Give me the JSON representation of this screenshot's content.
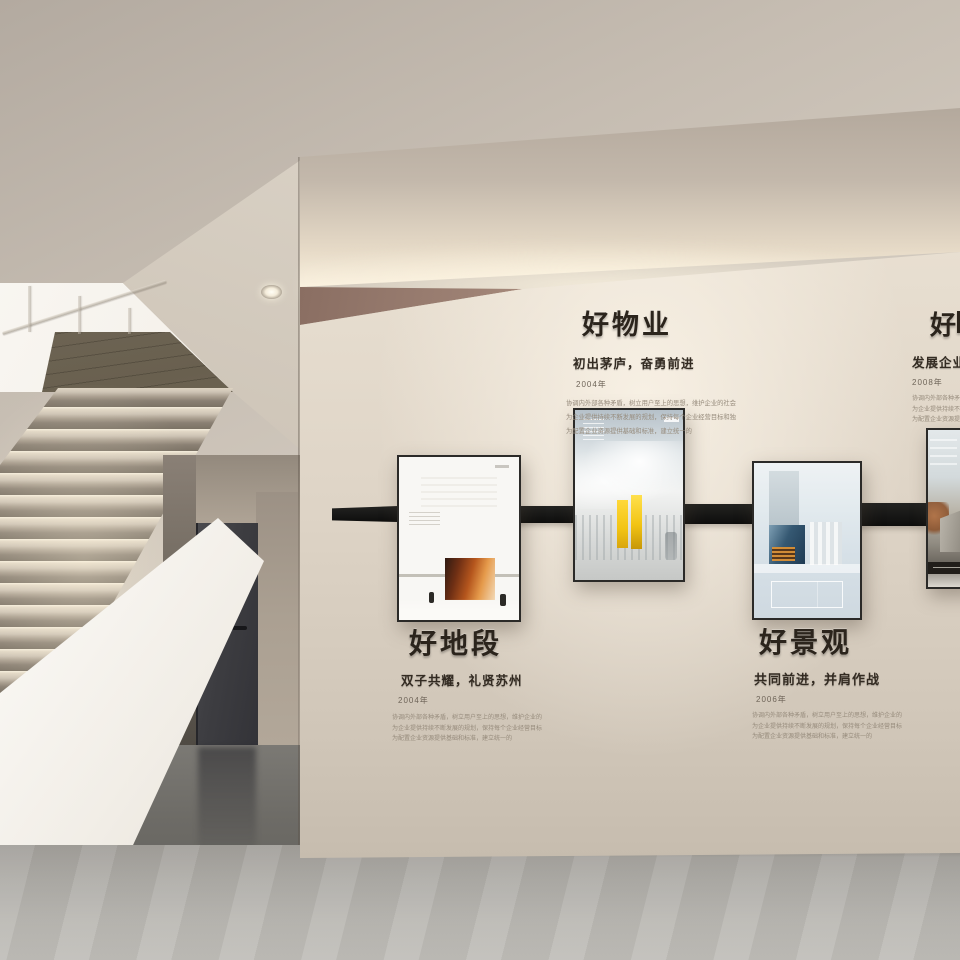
{
  "scene": {
    "name": "企业文化时间轴展示墙 · 室内效果图",
    "kind": "interior-render",
    "elements": [
      "staircase",
      "led-stair-lighting",
      "recessed-downlight",
      "charcoal-door",
      "timeline-wall",
      "exhibition-posters",
      "concrete-floor"
    ]
  },
  "palette": {
    "wall_beige": "#ddd3c5",
    "cove_glow": "#fdf4e0",
    "recess_brown": "#8d7165",
    "timeline_band": "#1a1918",
    "door_gray": "#3b3b3f",
    "floor_gray": "#b0aeaa",
    "accent_yellow": "#f2c414",
    "heading_ink": "#2b241c"
  },
  "sections": [
    {
      "title": "好物业",
      "subtitle": "初出茅庐，奋勇前进",
      "year": "2004年",
      "body": [
        "协调内外部各种矛盾，树立用户至上的思想，维护企业的社会形象",
        "为企业提供持续不断发展的规划，保持每个企业经营目标和独立企业",
        "为配置企业资源提供基础和标准，建立统一的"
      ]
    },
    {
      "title": "好地段",
      "subtitle": "双子共耀，礼贤苏州",
      "year": "2004年",
      "body": [
        "协调内外部各种矛盾，树立用户至上的思想，维护企业的社会形象",
        "为企业提供持续不断发展的规划，保持每个企业经营目标和独立企业",
        "为配置企业资源提供基础和标准，建立统一的"
      ]
    },
    {
      "title": "好景观",
      "subtitle": "共同前进，并肩作战",
      "year": "2006年",
      "body": [
        "协调内外部各种矛盾，树立用户至上的思想，维护企业的社会形象",
        "为企业提供持续不断发展的规划，保持每个企业经营目标和独立企业",
        "为配置企业资源提供基础和标准，建立统一的"
      ]
    },
    {
      "title": "好",
      "subtitle": "发展企业",
      "year": "2008年",
      "clipped": true,
      "body": [
        "协调内外部各种矛盾，树立用户至上的思想",
        "为企业提供持续不断发展的规划，保持每个企业",
        "为配置企业资源提供基础和标准，建立统一的"
      ]
    }
  ],
  "posters": [
    {
      "name": "winter-red-building-poster"
    },
    {
      "name": "yellow-twin-towers-poster"
    },
    {
      "name": "blue-stair-interior-poster"
    },
    {
      "name": "concrete-building-poster-partial"
    }
  ]
}
